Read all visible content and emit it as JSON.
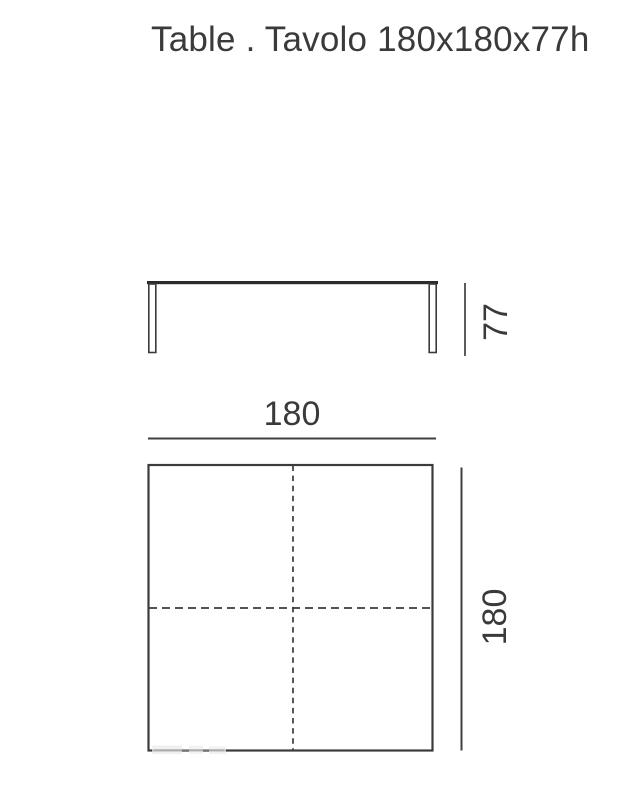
{
  "title": {
    "text": "Table . Tavolo 180x180x77h"
  },
  "product": {
    "type": "table",
    "width_cm": "180",
    "depth_cm": "180",
    "height_cm": "77"
  },
  "views": {
    "front_elevation": {
      "description": "front view of table with two legs",
      "height_dimension": {
        "value": "77"
      }
    },
    "top_plan": {
      "description": "square top view with dashed centerlines",
      "width_dimension": {
        "value": "180"
      },
      "depth_dimension": {
        "value": "180"
      }
    }
  },
  "colors": {
    "line": "#3f3f3f",
    "tabletop": "#2b2b2b",
    "text": "#3a3a3a",
    "background": "#ffffff"
  }
}
